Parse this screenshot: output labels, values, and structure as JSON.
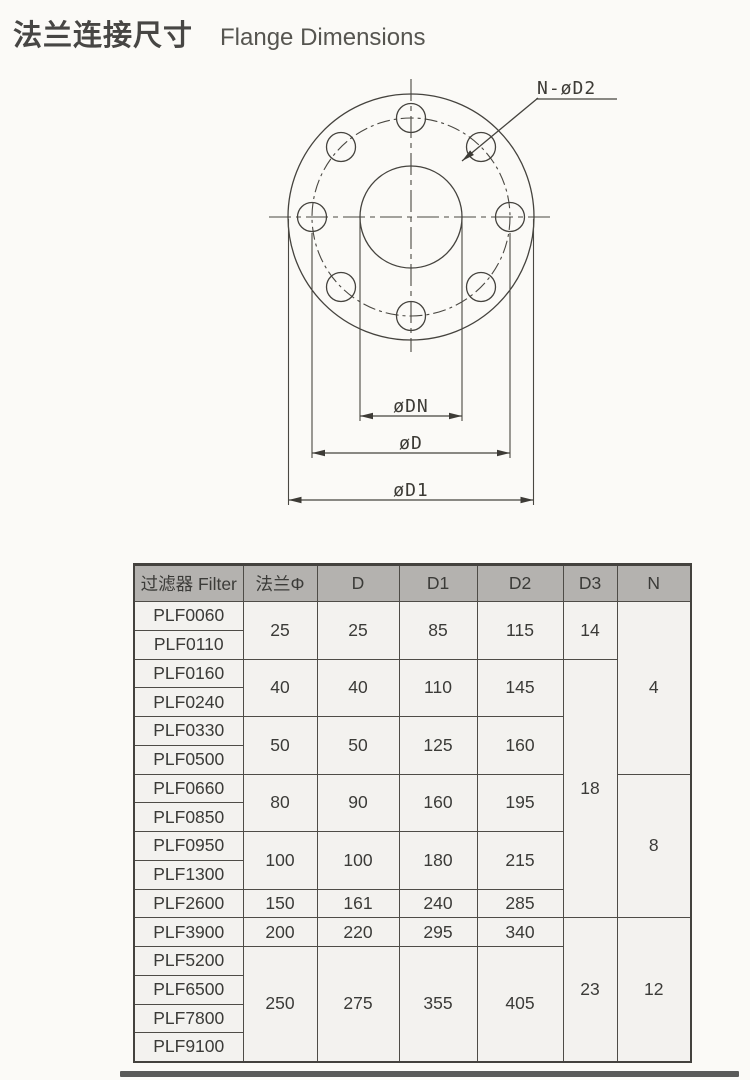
{
  "header": {
    "title_zh": "法兰连接尺寸",
    "title_en": "Flange Dimensions"
  },
  "diagram": {
    "callout_label": "N-øD2",
    "dim_labels": {
      "dn": "øDN",
      "d": "øD",
      "d1": "øD1"
    }
  },
  "table": {
    "headers": [
      "过滤器 Filter",
      "法兰Φ",
      "D",
      "D1",
      "D2",
      "D3",
      "N"
    ],
    "groups": [
      {
        "models": [
          "PLF0060",
          "PLF0110"
        ],
        "flange": "25",
        "d": "25",
        "d1": "85",
        "d2": "115"
      },
      {
        "models": [
          "PLF0160",
          "PLF0240"
        ],
        "flange": "40",
        "d": "40",
        "d1": "110",
        "d2": "145"
      },
      {
        "models": [
          "PLF0330",
          "PLF0500"
        ],
        "flange": "50",
        "d": "50",
        "d1": "125",
        "d2": "160"
      },
      {
        "models": [
          "PLF0660",
          "PLF0850"
        ],
        "flange": "80",
        "d": "90",
        "d1": "160",
        "d2": "195"
      },
      {
        "models": [
          "PLF0950",
          "PLF1300"
        ],
        "flange": "100",
        "d": "100",
        "d1": "180",
        "d2": "215"
      },
      {
        "models": [
          "PLF2600"
        ],
        "flange": "150",
        "d": "161",
        "d1": "240",
        "d2": "285"
      },
      {
        "models": [
          "PLF3900"
        ],
        "flange": "200",
        "d": "220",
        "d1": "295",
        "d2": "340"
      },
      {
        "models": [
          "PLF5200",
          "PLF6500",
          "PLF7800",
          "PLF9100"
        ],
        "flange": "250",
        "d": "275",
        "d1": "355",
        "d2": "405"
      }
    ],
    "d3_spans": [
      {
        "value": "14",
        "rows": 2
      },
      {
        "value": "18",
        "rows": 9
      },
      {
        "value": "23",
        "rows": 5
      }
    ],
    "n_spans": [
      {
        "value": "4",
        "rows": 6
      },
      {
        "value": "8",
        "rows": 5
      },
      {
        "value": "12",
        "rows": 5
      }
    ]
  },
  "colors": {
    "header_bg": "#b4b2af",
    "cell_bg": "#f3f2ef",
    "table_border": "#4e4c47",
    "drawing_line": "#45433e",
    "text": "#3b3b38",
    "footer_bar": "#5a5a58"
  }
}
